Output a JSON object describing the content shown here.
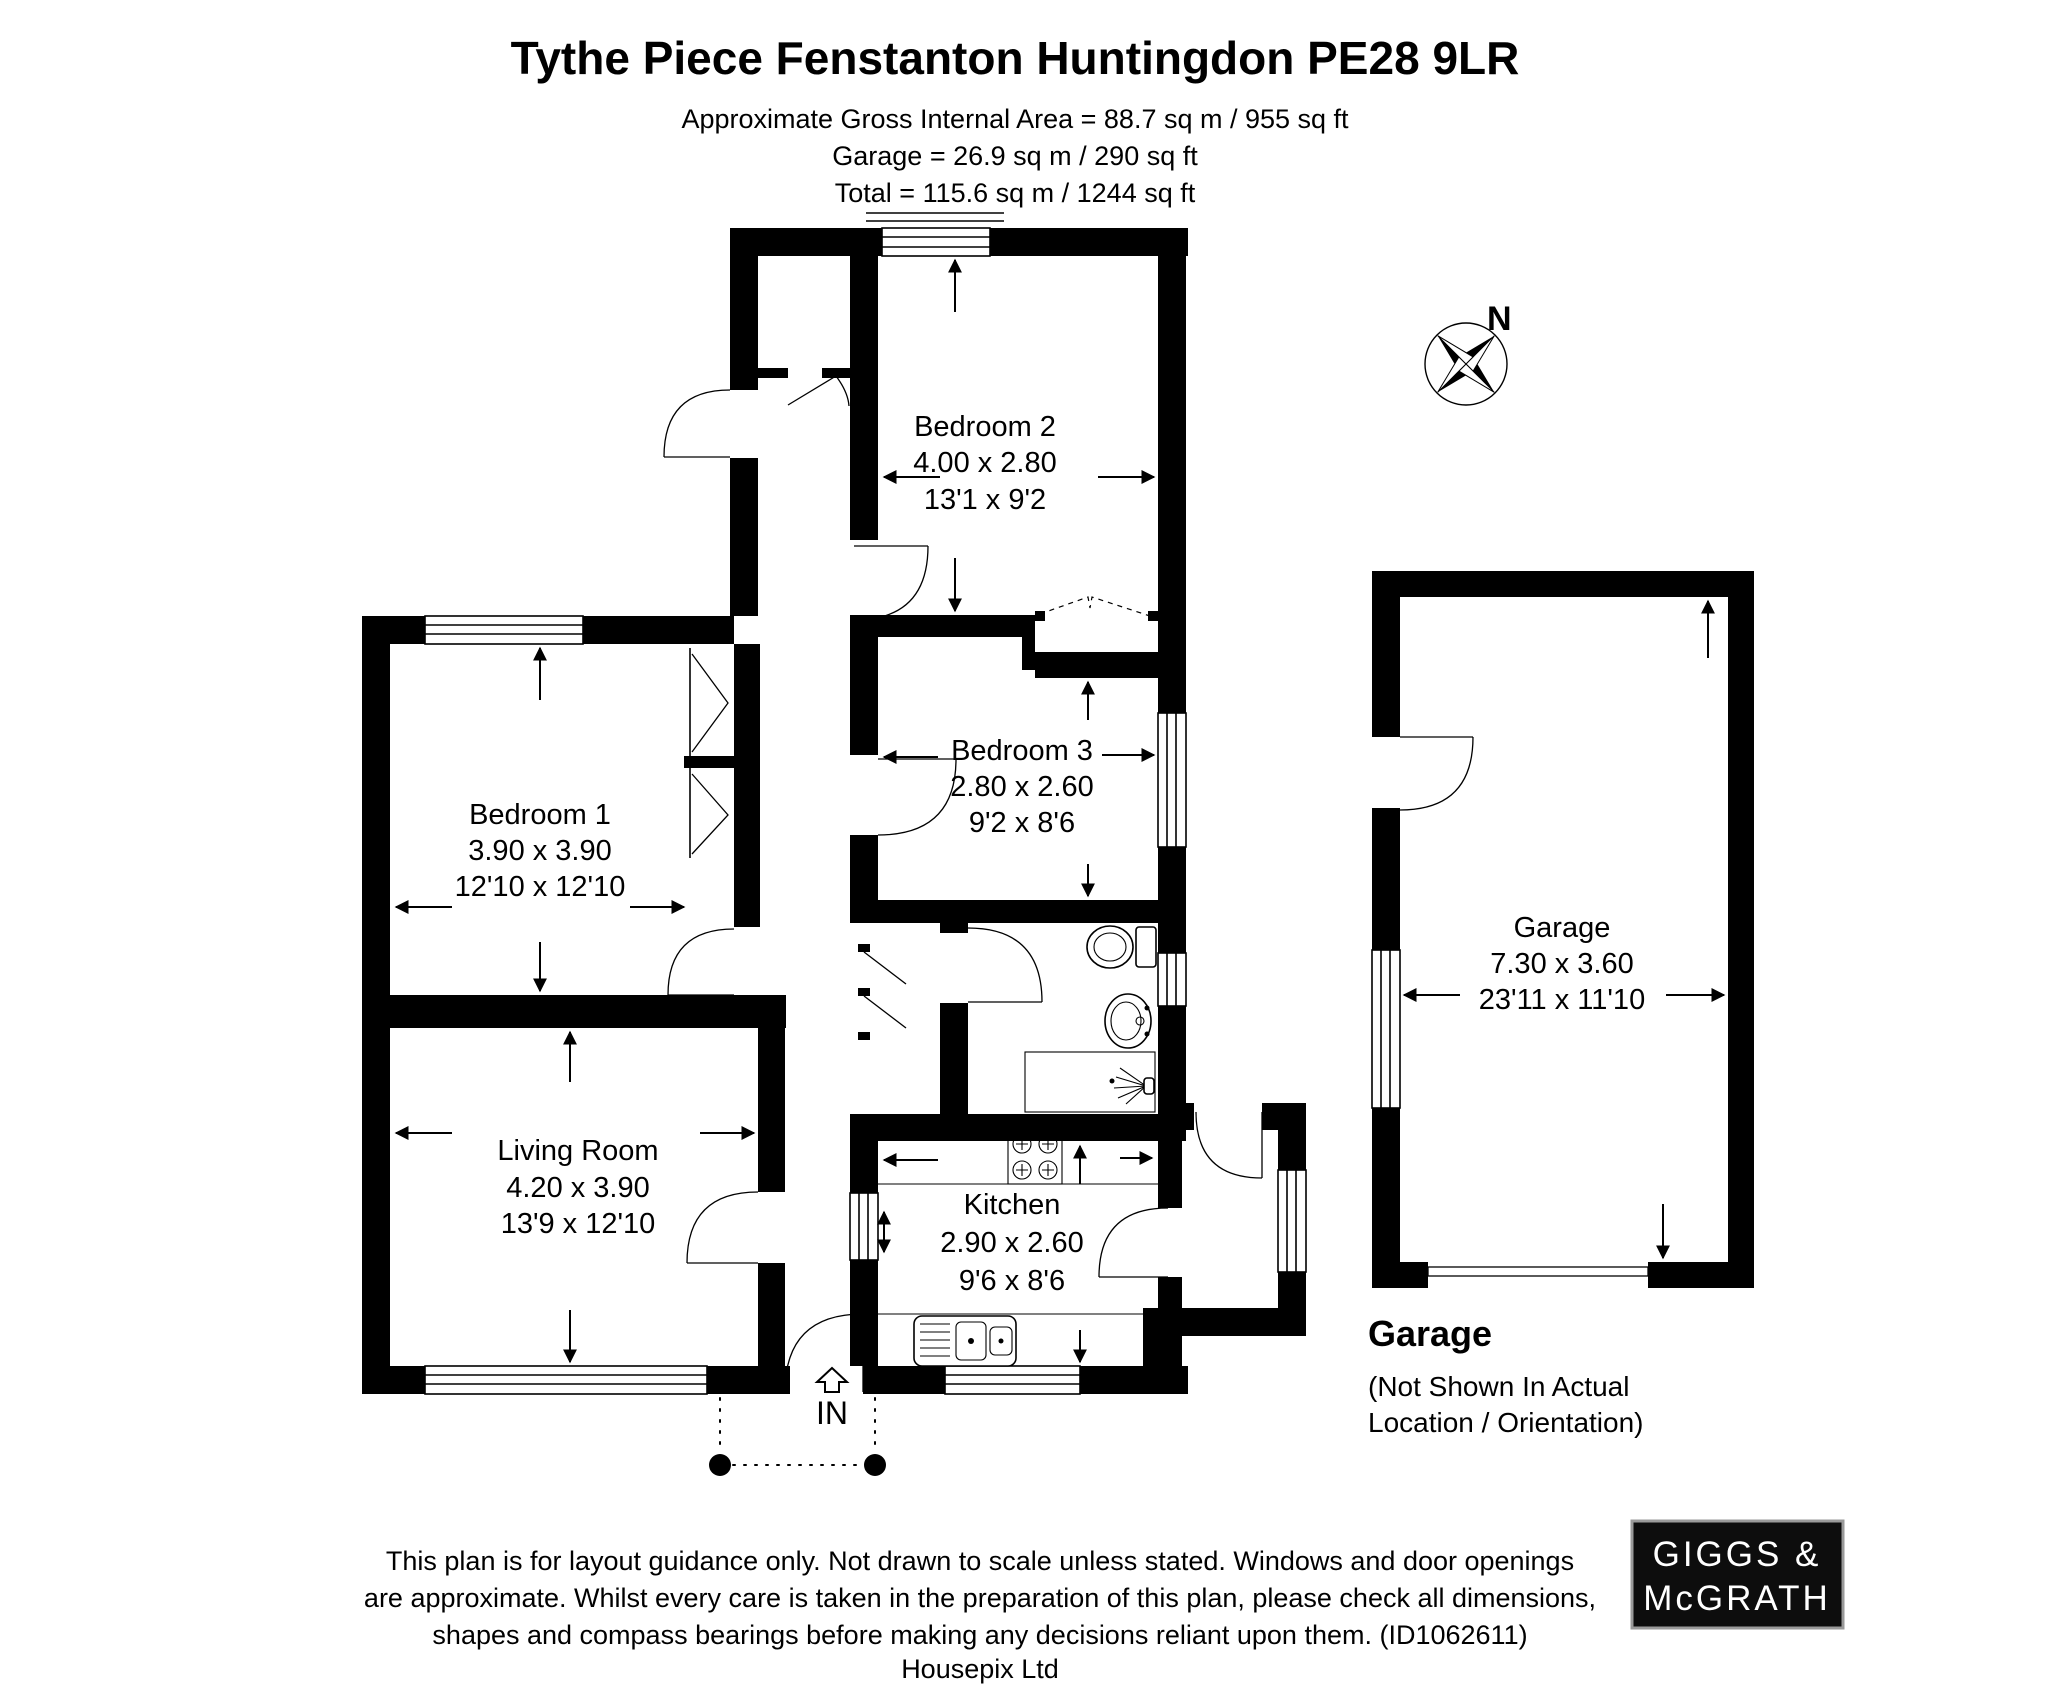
{
  "header": {
    "title": "Tythe Piece Fenstanton Huntingdon PE28 9LR",
    "area_line1": "Approximate Gross Internal Area = 88.7 sq m / 955 sq ft",
    "area_line2": "Garage = 26.9 sq m / 290 sq ft",
    "area_line3": "Total = 115.6 sq m / 1244 sq ft"
  },
  "compass": {
    "north_label": "N"
  },
  "rooms": {
    "bedroom2": {
      "name": "Bedroom 2",
      "size_metric": "4.00 x 2.80",
      "size_imperial": "13'1 x 9'2"
    },
    "bedroom3": {
      "name": "Bedroom 3",
      "size_metric": "2.80 x 2.60",
      "size_imperial": "9'2 x 8'6"
    },
    "bedroom1": {
      "name": "Bedroom 1",
      "size_metric": "3.90 x 3.90",
      "size_imperial": "12'10 x 12'10"
    },
    "living_room": {
      "name": "Living Room",
      "size_metric": "4.20 x 3.90",
      "size_imperial": "13'9 x 12'10"
    },
    "kitchen": {
      "name": "Kitchen",
      "size_metric": "2.90 x 2.60",
      "size_imperial": "9'6 x 8'6"
    },
    "garage": {
      "name": "Garage",
      "size_metric": "7.30 x 3.60",
      "size_imperial": "23'11 x 11'10"
    }
  },
  "entrance": {
    "label": "IN"
  },
  "garage_note": {
    "title": "Garage",
    "line1": "(Not Shown In Actual",
    "line2": "Location / Orientation)"
  },
  "footer": {
    "line1": "This plan is for layout guidance only. Not drawn to scale unless stated. Windows and door openings",
    "line2": "are approximate. Whilst every care is taken in the preparation of this plan, please check all dimensions,",
    "line3": "shapes and compass bearings before making any decisions reliant upon them. (ID1062611)",
    "credit": "Housepix Ltd"
  },
  "logo": {
    "line1": "GIGGS &",
    "line2": "McGRATH"
  },
  "colors": {
    "wall": "#000000",
    "background": "#ffffff",
    "logo_bg": "#0d0d0d",
    "logo_text": "#ffffff"
  }
}
